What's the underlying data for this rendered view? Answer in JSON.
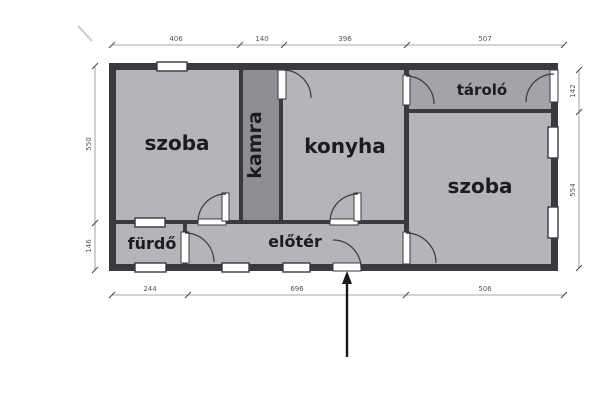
{
  "plan": {
    "rooms": {
      "szoba_left": "szoba",
      "kamra": "kamra",
      "konyha": "konyha",
      "tarolo": "tároló",
      "szoba_right": "szoba",
      "furdo": "fürdő",
      "eloter": "előtér"
    },
    "dimensions": {
      "top": [
        "406",
        "140",
        "396",
        "507"
      ],
      "bottom": [
        "244",
        "696",
        "506"
      ],
      "left": [
        "550",
        "146"
      ],
      "right": [
        "142",
        "554"
      ]
    },
    "colors": {
      "room_fill": "#b5b5b9",
      "kamra_fill": "#8e8e92",
      "tarolo_fill": "#a4a4a8",
      "wall": "#3a3a3e",
      "dimension_line": "#8a8a8a",
      "dimension_text": "#555555",
      "background": "#ffffff",
      "arrow": "#1a1a1a"
    }
  }
}
